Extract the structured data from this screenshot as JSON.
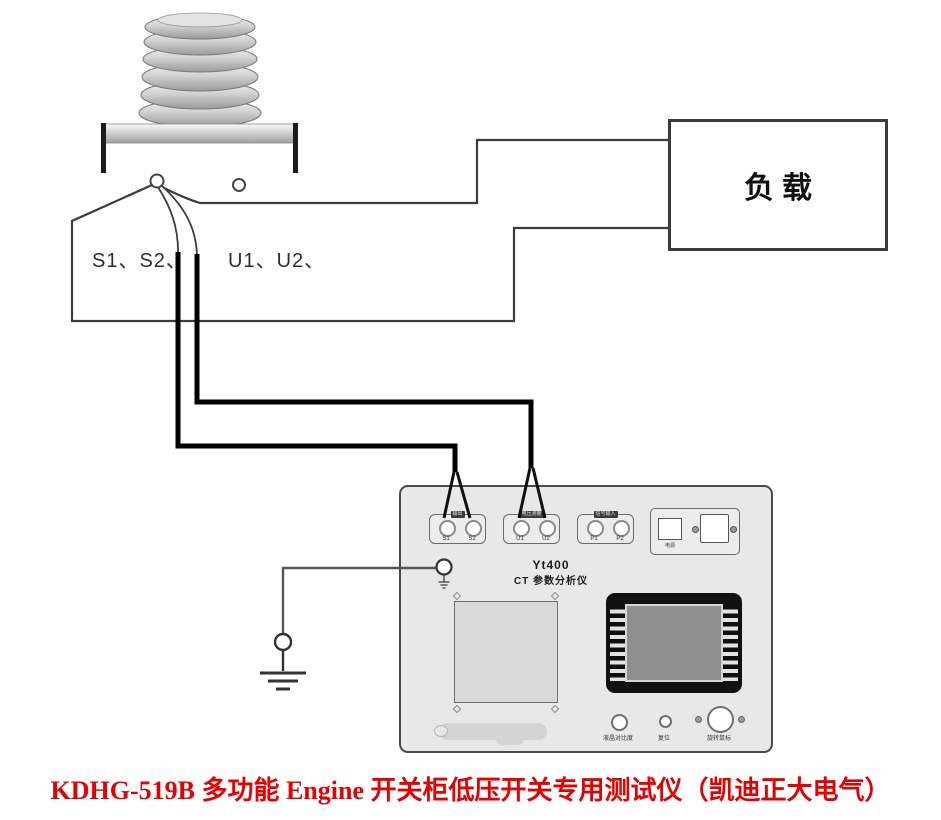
{
  "colors": {
    "caption_red": "#e60000",
    "panel_gray": "#e8e8e8",
    "pad_gray": "#d9d9d9",
    "screen_gray": "#8f8f8f",
    "wire_black": "#000000",
    "line_gray": "#3c3c3c"
  },
  "transformer": {
    "secondary_label": "S1、S2、",
    "voltage_label": "U1、U2、"
  },
  "load": {
    "label": "负载"
  },
  "instrument": {
    "model": "Yt400",
    "title": "CT 参数分析仪",
    "groups": [
      {
        "tag": "输出",
        "a": "S1",
        "b": "S2"
      },
      {
        "tag": "电压测量",
        "a": "U1",
        "b": "U2"
      },
      {
        "tag": "信号输入",
        "a": "P1",
        "b": "P2"
      }
    ],
    "power": {
      "label": "电源"
    },
    "controls": {
      "contrast": "液晶对比度",
      "reset": "复位",
      "mouse": "旋转鼠标"
    }
  },
  "caption": "KDHG-519B 多功能 Engine 开关柜低压开关专用测试仪（凯迪正大电气）"
}
